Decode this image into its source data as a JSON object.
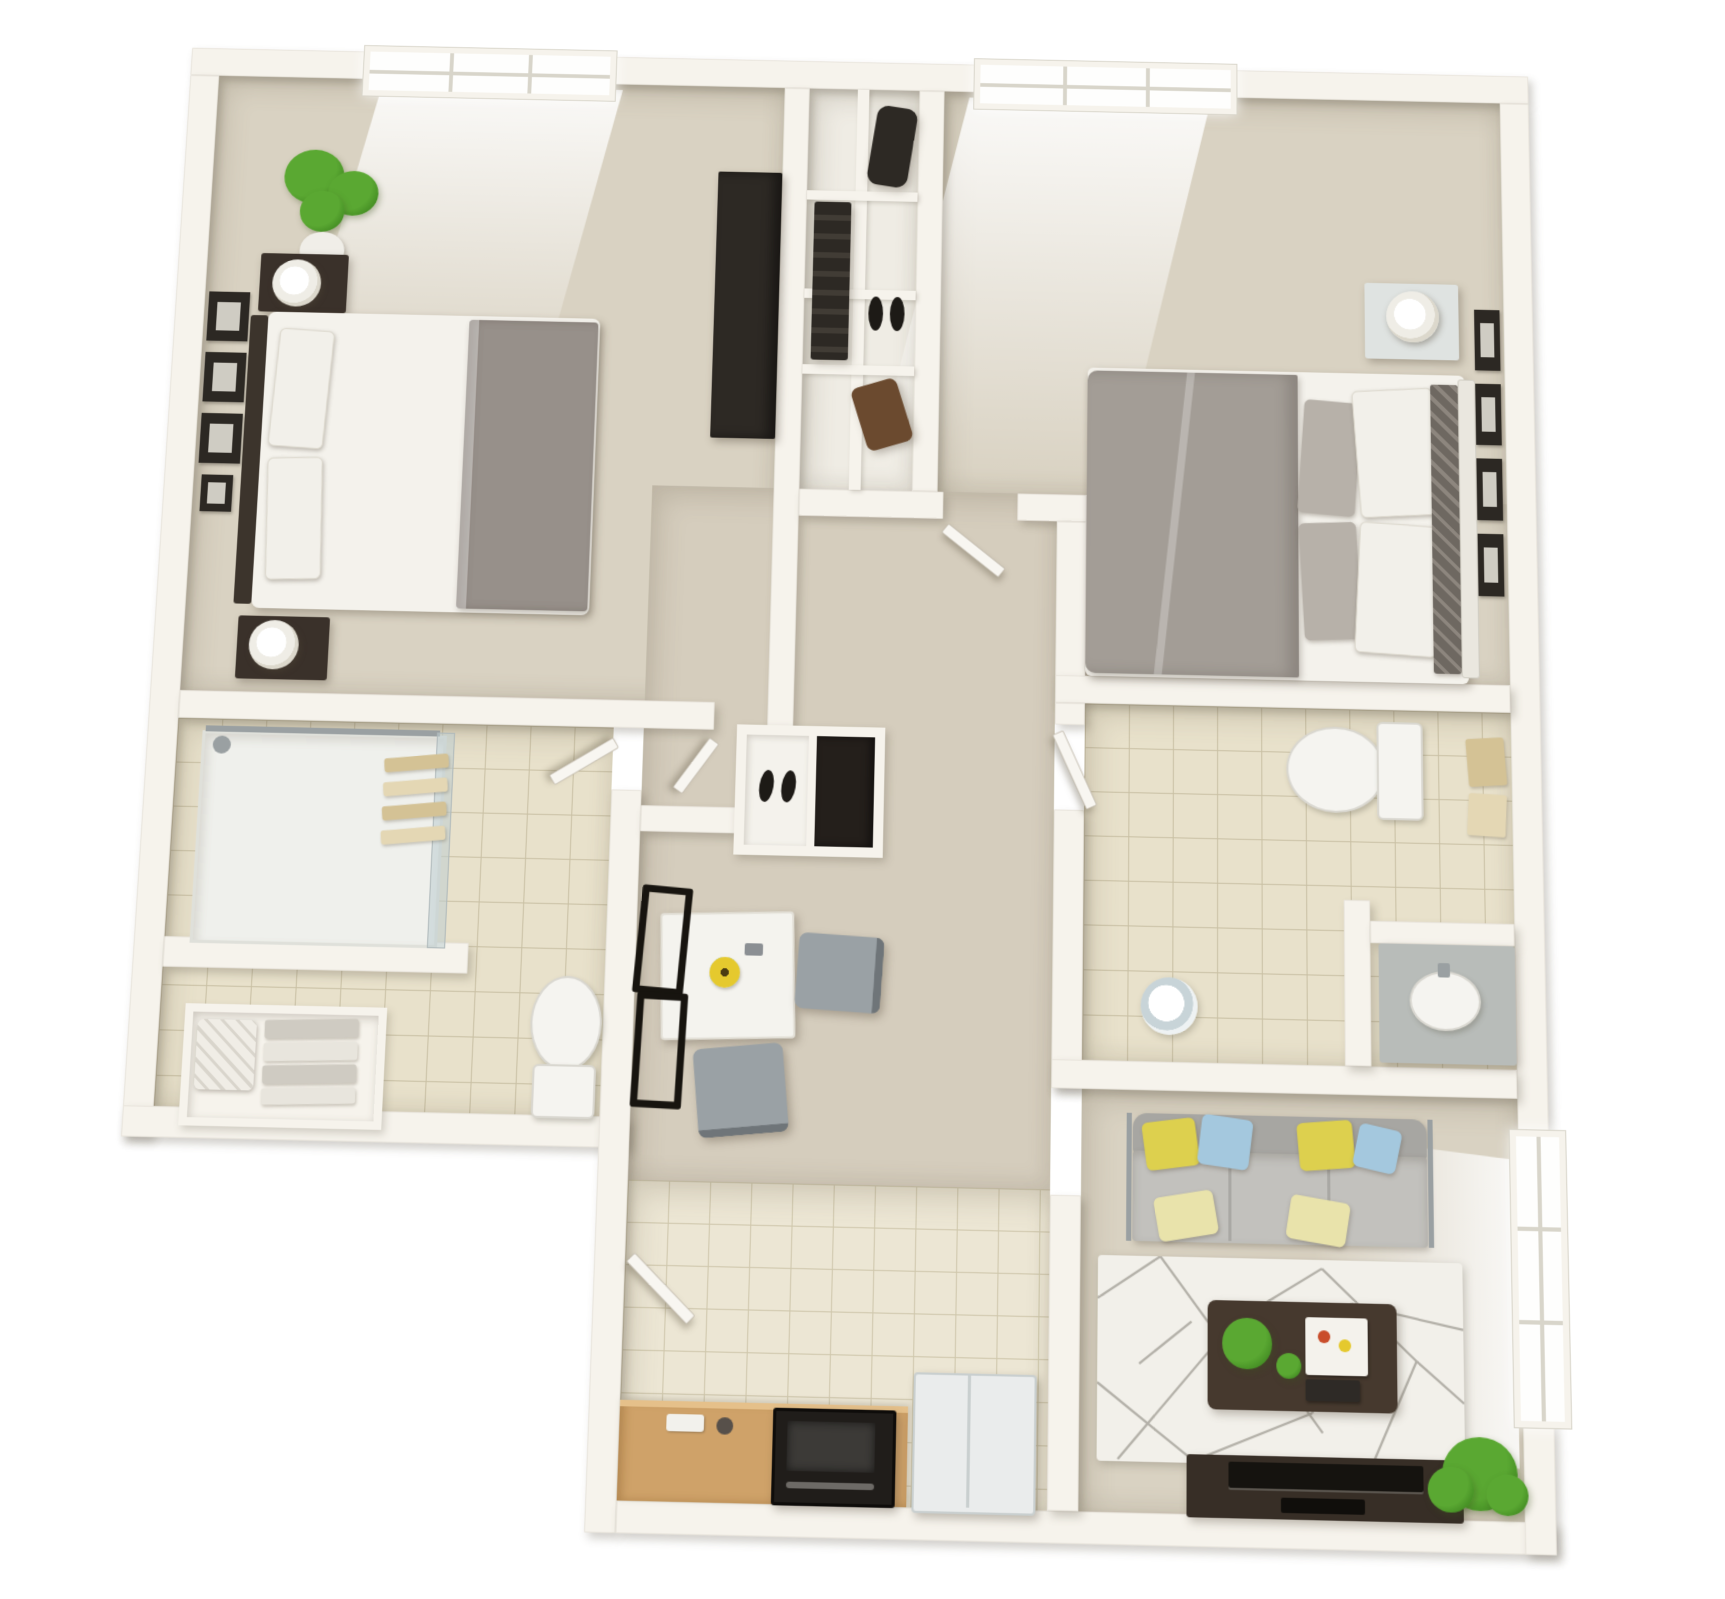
{
  "scene": {
    "subject": "3d-rendered-floor-plan",
    "unit_type": "two-bedroom-two-bathroom-apartment",
    "view": "top-down-3d-dollhouse",
    "visible_text": ""
  },
  "colors": {
    "background": "#ffffff",
    "wall": "#f6f3ec",
    "wall_shadow": "rgba(104,96,78,0.30)",
    "carpet": "#d9d2c2",
    "carpet_hall": "#d5cdbd",
    "closet_floor": "#efece4",
    "tile": "#e8e1cb",
    "tile_line": "#c9c0a4",
    "kitchen_tile": "#ece6d4",
    "kitchen_tile_line": "#cfc7ac",
    "window_glow": "#fefefd",
    "mullion": "#d8d5ca",
    "door": "#f8f6f1",
    "counter": "#cfa269",
    "counter_top": "#e5c08a",
    "stove": "#201d1a",
    "stove_panel": "#3c3a37",
    "fridge": "#eaecec",
    "fridge_edge": "#c9cfcf",
    "sofa_back": "#a7a6a2",
    "sofa_seat": "#c2c1bd",
    "cushion_pale": "#e9e3ab",
    "pillow_yellow": "#ddd04e",
    "pillow_blue": "#a4c8de",
    "rug": "#f2f0ea",
    "rug_line": "#b3b0a8",
    "wood": "#46392e",
    "console": "#372e26",
    "tv": "#15130f",
    "plant": "#5aa832",
    "plant_dark": "#3d851f",
    "pot": "#f0eee8",
    "bed_sheet": "#f4f2ec",
    "bed_blanket": "#97908a",
    "duvet": "#a39d96",
    "pillow_white": "#f2f0ea",
    "pillow_gray": "#b7b1a9",
    "pillow_pattern": "#6e6861",
    "headboard_dark": "#3c342c",
    "headboard_light": "#eae7df",
    "nightstand": "#3a312a",
    "nightstand_light": "#dfe3e1",
    "lamp": "#efede6",
    "frame_dark": "#2c2823",
    "frame_mat": "#cfccc3",
    "porcelain": "#f5f4f0",
    "porcelain_shade": "#d9d7d0",
    "towel": "#d4c295",
    "towel_light": "#e4d7b4",
    "glass": "rgba(190,205,210,0.55)",
    "chrome": "#9aa0a2",
    "vanity": "#b8bcb9",
    "table_white": "#f4f3ee",
    "chair_seat": "#9aa1a5",
    "chair_frame": "#17140f",
    "clothes_dark": "#2d2924",
    "clothes_brown": "#6b4a2f",
    "shoe_dark": "#1d1a16",
    "flower_yellow": "#e5c92e"
  },
  "floorplan": {
    "rooms": [
      {
        "id": "bedroom-1",
        "position": "top-left",
        "furniture": [
          "double-bed",
          "gray-blanket",
          "headboard",
          "nightstand-upper",
          "nightstand-lower",
          "table-lamp-upper",
          "table-lamp-lower",
          "potted-plant",
          "wall-art-frames",
          "wardrobe",
          "window"
        ]
      },
      {
        "id": "closet",
        "position": "top-center",
        "furniture": [
          "shelving-unit",
          "hanging-clothes",
          "garment-bag",
          "shoes",
          "storage-box"
        ]
      },
      {
        "id": "bedroom-2",
        "position": "top-right",
        "furniture": [
          "double-bed",
          "gray-duvet",
          "pillows",
          "patterned-runner",
          "headboard",
          "nightstand",
          "table-lamp",
          "wall-art-frames",
          "window"
        ]
      },
      {
        "id": "bathroom-2",
        "position": "middle-right",
        "furniture": [
          "toilet",
          "towel-rack",
          "vanity-sink",
          "shower-stool",
          "tile-floor"
        ]
      },
      {
        "id": "bathroom-1",
        "position": "middle-left",
        "furniture": [
          "walk-in-shower",
          "glass-panel",
          "shower-bar",
          "towel-rack",
          "linen-shelf",
          "cushion",
          "folded-towels",
          "toilet",
          "tile-floor"
        ]
      },
      {
        "id": "hallway",
        "position": "center",
        "furniture": [
          "door-bedroom-1",
          "door-bedroom-2",
          "door-bathroom-1",
          "door-bathroom-2",
          "door-kitchen"
        ]
      },
      {
        "id": "dining-nook",
        "position": "center-left",
        "furniture": [
          "shoe-cabinet",
          "dining-table",
          "flower-centerpiece",
          "chair-right",
          "chair-bottom",
          "chair-frames"
        ]
      },
      {
        "id": "kitchen",
        "position": "bottom-center",
        "furniture": [
          "counter",
          "cooktop-oven",
          "refrigerator",
          "tile-floor"
        ]
      },
      {
        "id": "living-room",
        "position": "bottom-right",
        "furniture": [
          "sofa",
          "throw-pillows-yellow-blue",
          "area-rug-geometric",
          "coffee-table",
          "coffee-table-plant",
          "tray",
          "books",
          "tv-console",
          "television",
          "floor-plant",
          "window"
        ]
      }
    ],
    "windows": [
      {
        "room": "bedroom-1",
        "wall": "top",
        "panes": 6
      },
      {
        "room": "bedroom-2",
        "wall": "top",
        "panes": 6
      },
      {
        "room": "living-room",
        "wall": "right",
        "panes": 6
      }
    ]
  }
}
